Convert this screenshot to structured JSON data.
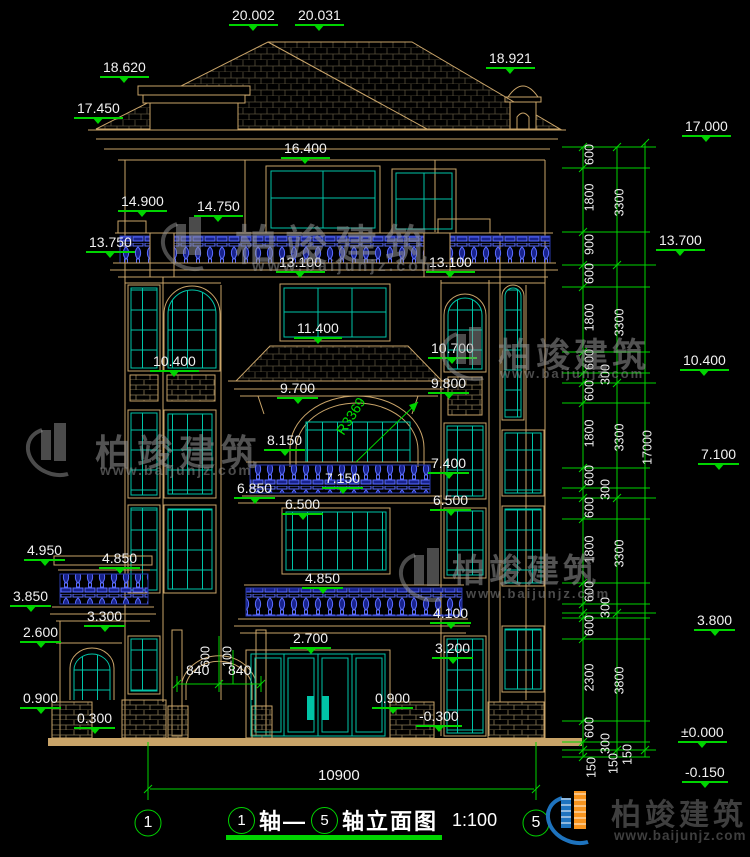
{
  "drawing": {
    "type": "building-elevation",
    "sheet_title_axis1": "1",
    "sheet_title_axis2": "5",
    "sheet_title_part1": "轴—",
    "sheet_title_part2": "轴立面图",
    "scale": "1:100"
  },
  "logo": {
    "brand": "柏竣建筑",
    "site": "www.baijunjz.com"
  },
  "colors": {
    "dim_green": "#00d400",
    "wall_tan": "#c9a469",
    "window_teal": "#00c4a7",
    "baluster_blue": "#3a50d9",
    "logo_blue": "#1e73be",
    "logo_orange": "#f7941e"
  },
  "ann": {
    "levels": [
      "20.002",
      "20.031",
      "18.620",
      "17.450",
      "18.921",
      "16.400",
      "14.900",
      "14.750",
      "13.750",
      "13.100",
      "13.100",
      "11.400",
      "10.400",
      "10.700",
      "9.800",
      "9.700",
      "8.150",
      "7.150",
      "6.850",
      "6.500",
      "7.400",
      "6.500",
      "4.950",
      "4.850",
      "4.850",
      "3.850",
      "3.300",
      "2.600",
      "4.100",
      "3.200",
      "2.700",
      "0.900",
      "0.300",
      "0.900",
      "-0.300"
    ],
    "right_levels": [
      "17.000",
      "13.700",
      "10.400",
      "7.100",
      "3.800",
      "±0.000",
      "-0.150"
    ],
    "chain_a": [
      "600",
      "1800",
      "900",
      "600",
      "1800",
      "600",
      "300",
      "600",
      "1800",
      "600",
      "300",
      "600",
      "1800",
      "600",
      "300",
      "600",
      "2300",
      "600",
      "300"
    ],
    "chain_b": [
      "3300",
      "3300",
      "3300",
      "3300",
      "3800"
    ],
    "chain_c": [
      "17000"
    ],
    "chain_s": [
      "150",
      "150",
      "150"
    ],
    "arch": [
      "840",
      "840",
      "600",
      "100"
    ],
    "radius": "R3369",
    "dim_width": "10900"
  }
}
